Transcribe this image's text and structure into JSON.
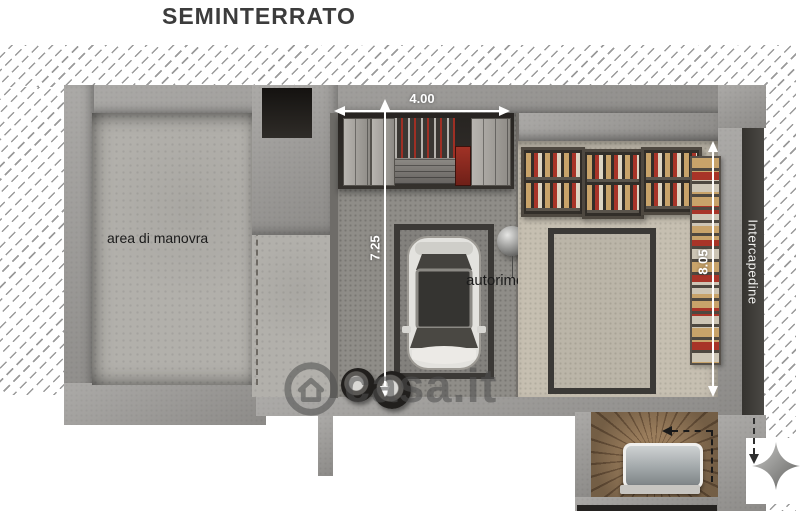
{
  "title": "SEMINTERRATO",
  "labels": {
    "maneuver_area": "area di manovra",
    "garage": "autorimessa",
    "cavity": "Intercapedine"
  },
  "dimensions": {
    "garage_width_m": "4.00",
    "garage_depth_m": "7.25",
    "storage_depth_m": "8.05"
  },
  "watermark": {
    "text": "casa.it",
    "icon": "house-in-circle"
  },
  "icons": {
    "north_indicator": "four-point-star",
    "car": "car-top-view",
    "lamp": "pendant-lamp"
  },
  "colors": {
    "wall": "#9c9a97",
    "floor_concrete": "#b2b0ab",
    "floor_garage": "#8f8d88",
    "floor_storage": "#c6bfb1",
    "parking_outline": "#3b3936",
    "cavity_band": "#3f3e3c",
    "dimension": "#ffffff",
    "text": "#1b1b1b",
    "wood_light": "#9a7d5c",
    "wood_dark": "#73593f",
    "watermark": "#50505090"
  }
}
